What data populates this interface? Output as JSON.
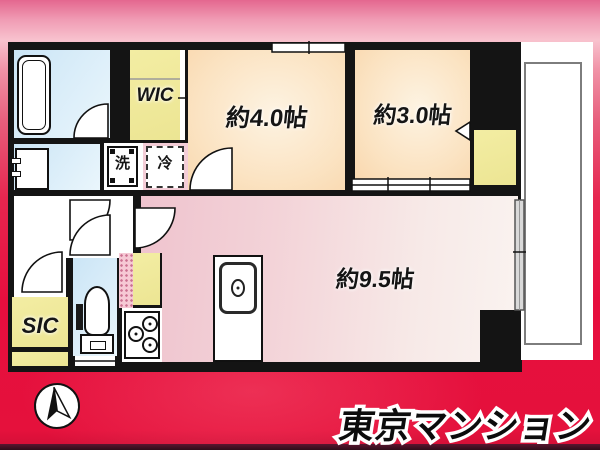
{
  "branding": {
    "logo_text": "東京マンション"
  },
  "compass": {
    "direction": "north"
  },
  "rooms": {
    "wic": "WIC",
    "bedroom_4": "約4.0帖",
    "bedroom_3": "約3.0帖",
    "living_95": "約9.5帖",
    "sic": "SIC",
    "washer": "洗",
    "fridge": "冷"
  },
  "colors": {
    "background_top_pink": "#ea6f9b",
    "background_red": "#e60f3e",
    "bottom_bar": "#441021",
    "wall_black": "#141414",
    "room_yellow": "#f1eb9a",
    "room_peach": "#f8d3a6",
    "room_blue": "#cbe5f6",
    "room_pink": "#efc4ce",
    "balcony_white": "#ffffff"
  }
}
